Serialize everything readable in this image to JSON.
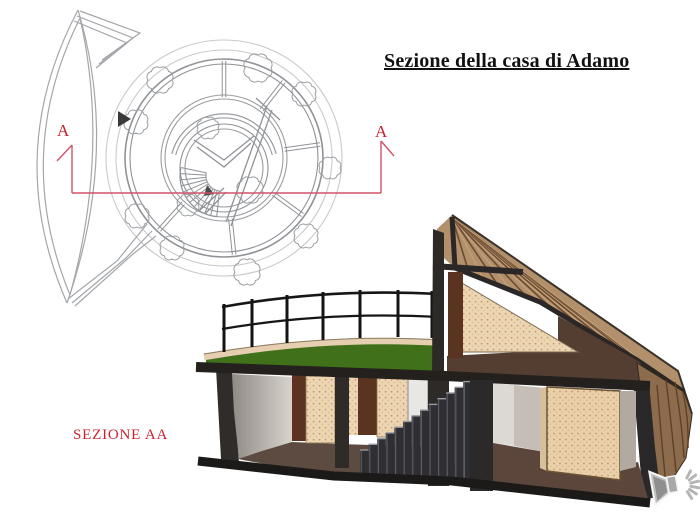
{
  "slide": {
    "title": "Sezione della casa di Adamo",
    "section_label": "SEZIONE AA",
    "plan": {
      "marker_left": "A",
      "marker_right": "A"
    },
    "colors": {
      "accent_red": "#c32031",
      "section_line": "#cf5468",
      "plan_line": "#9a9da1",
      "roof_wood": "#b2906b",
      "roof_wood_dark": "#6b4c33",
      "terrace_green": "#41701a",
      "cut_dark": "#2b2927",
      "wall_beige": "#ecd5b2",
      "floor_brown": "#5d4a40",
      "door_brown": "#5a3420",
      "speaker_gray": "#c2c2c2"
    },
    "icons": {
      "speaker": "speaker-icon"
    }
  }
}
